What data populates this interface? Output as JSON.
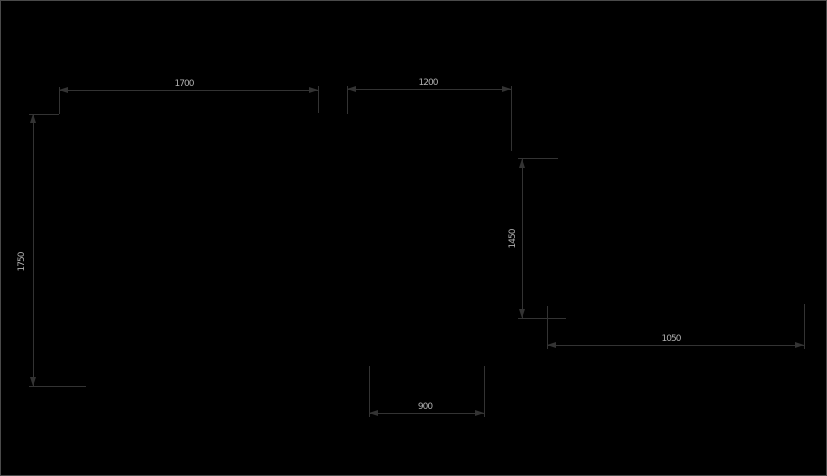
{
  "drawing": {
    "description": "CAD dimension drawing on black background",
    "background_color": "#000000",
    "line_color": "#333333",
    "text_color": "#b0b0b0",
    "border_color": "#4a4a4a",
    "dimensions": [
      {
        "id": "top-left-width",
        "value": "1700",
        "orientation": "horizontal"
      },
      {
        "id": "top-right-width",
        "value": "1200",
        "orientation": "horizontal"
      },
      {
        "id": "left-height",
        "value": "1750",
        "orientation": "vertical"
      },
      {
        "id": "right-height",
        "value": "1450",
        "orientation": "vertical"
      },
      {
        "id": "bottom-right-width",
        "value": "1050",
        "orientation": "horizontal"
      },
      {
        "id": "bottom-center-width",
        "value": "900",
        "orientation": "horizontal"
      }
    ]
  }
}
